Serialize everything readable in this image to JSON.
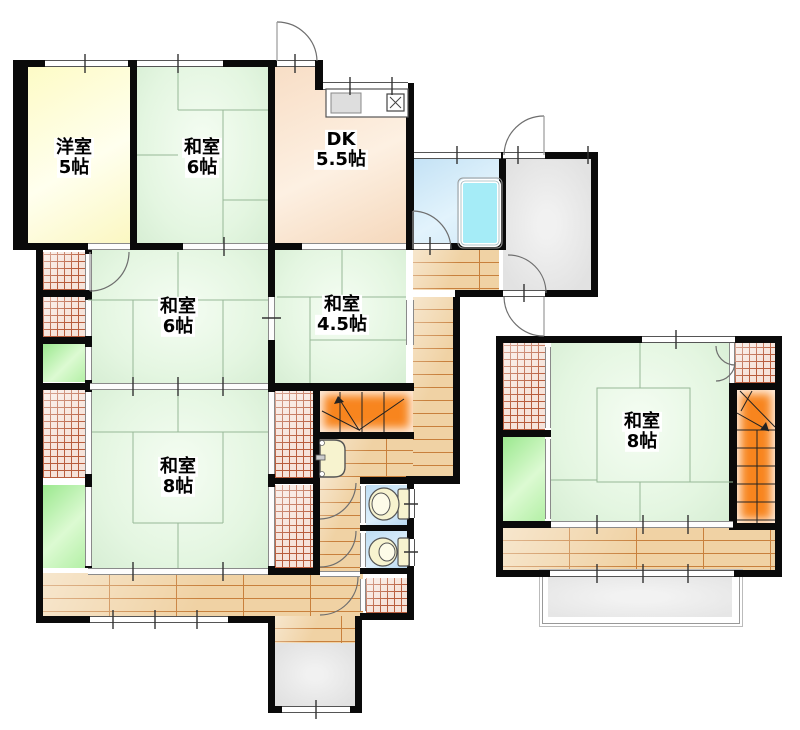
{
  "plan": {
    "type": "floor-plan",
    "unit_suffix": "帖"
  },
  "rooms": [
    {
      "id": "western-room-5",
      "name": "洋室",
      "size": "5帖"
    },
    {
      "id": "japanese-room-6-top",
      "name": "和室",
      "size": "6帖"
    },
    {
      "id": "dining-kitchen",
      "name": "DK",
      "size": "5.5帖"
    },
    {
      "id": "japanese-room-6-mid",
      "name": "和室",
      "size": "6帖"
    },
    {
      "id": "japanese-room-4-5",
      "name": "和室",
      "size": "4.5帖"
    },
    {
      "id": "japanese-room-8-main",
      "name": "和室",
      "size": "8帖"
    },
    {
      "id": "japanese-room-8-annex",
      "name": "和室",
      "size": "8帖"
    }
  ],
  "icons": {
    "kitchen_counter": "sink-and-stove",
    "bathtub": "bathtub",
    "washbasin": "washbasin",
    "toilet": "toilet-bowl",
    "stairs": "staircase-with-up-arrow",
    "doors": "quarter-circle-swing-arcs"
  },
  "colors": {
    "wall": "#0a0a0a",
    "tatami": "#e4f6e1",
    "western": "#fdfbc6",
    "dk": "#f8dec6",
    "wood": "#f0d2a4",
    "stairs": "#f8851e",
    "hatchbg": "#f6e3da",
    "hatchline": "#b85c3c",
    "greenc": "#b4f0a6",
    "bath": "#cfe8f7",
    "bathtub_fill": "#a5ecf7",
    "toilet": "#bfddf3",
    "gray": "#e2e2e2"
  }
}
